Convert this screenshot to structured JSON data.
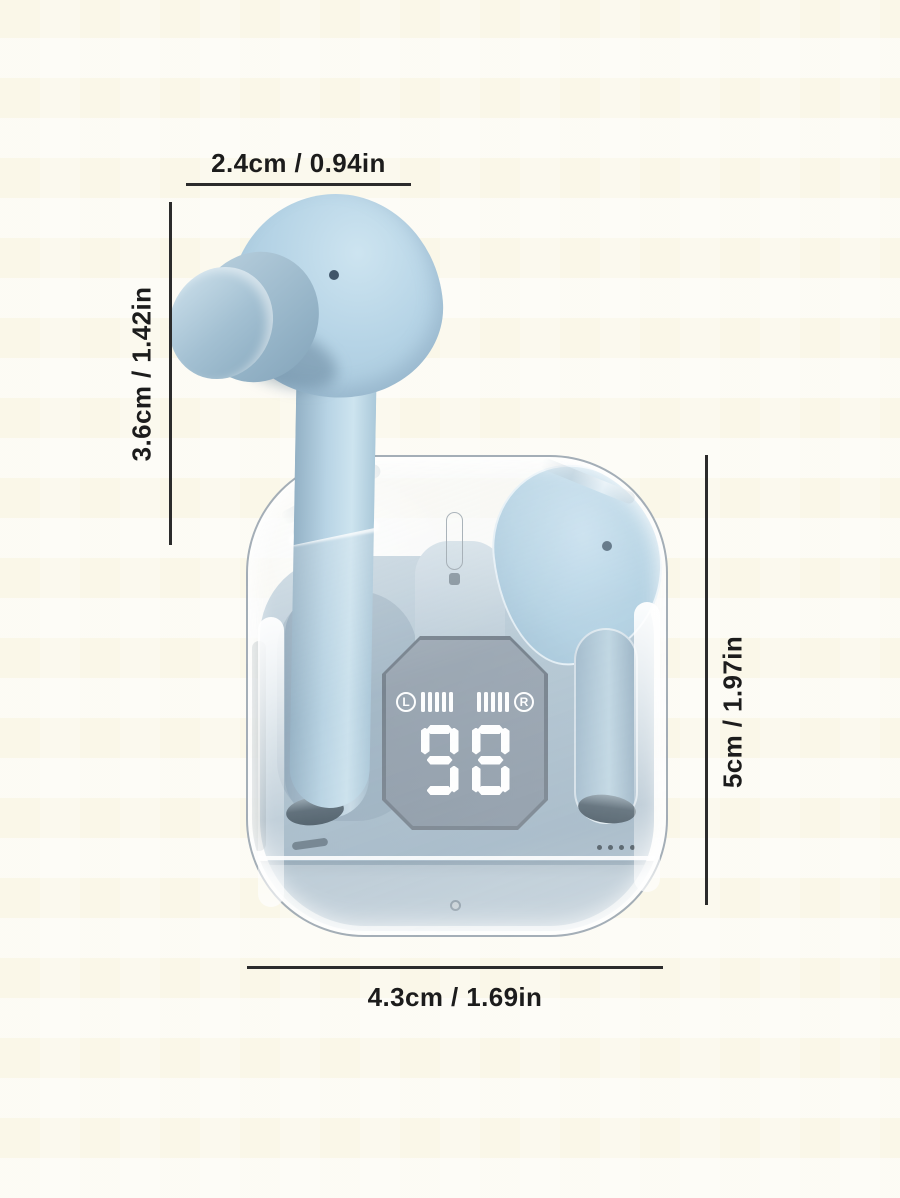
{
  "scene": {
    "background_color": "#fbf9ee"
  },
  "annotations": {
    "line_color": "#2b2b2b",
    "top": {
      "label": "2.4cm / 0.94in"
    },
    "left": {
      "label": "3.6cm / 1.42in"
    },
    "right": {
      "label": "5cm / 1.97in"
    },
    "bottom": {
      "label": "4.3cm / 1.69in"
    }
  },
  "product": {
    "description": "sky-blue wireless earbud with transparent charging case",
    "earbud_color": "#b4d2e4",
    "display": {
      "battery_level": "98",
      "left_channel_label": "L",
      "right_channel_label": "R",
      "bars_per_channel": 5,
      "digit_color": "#ffffff"
    }
  }
}
